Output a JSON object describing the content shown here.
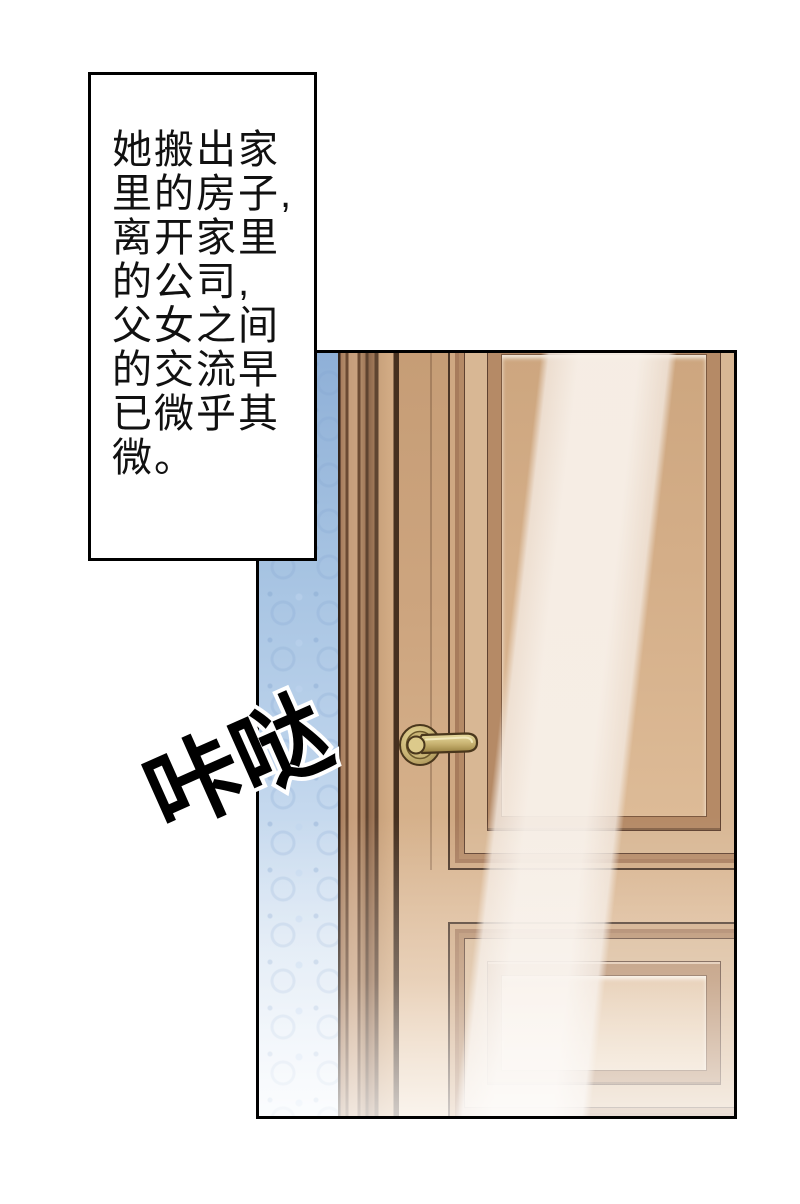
{
  "narration": {
    "text": "她搬出家\n里的房子,\n离开家里\n的公司,\n父女之间\n的交流早\n已微乎其\n微。"
  },
  "sfx": {
    "text": "咔哒"
  },
  "scene": {
    "wallpaper_color": "#a8c4e3",
    "door_color": "#cda57f",
    "door_frame_dark": "#6b4a33",
    "panel_field_color": "#ddbb97",
    "handle_brass_color": "#c9b475",
    "glare_color": "#f8f1ea",
    "outline_color": "#000000",
    "page_background": "#ffffff"
  }
}
